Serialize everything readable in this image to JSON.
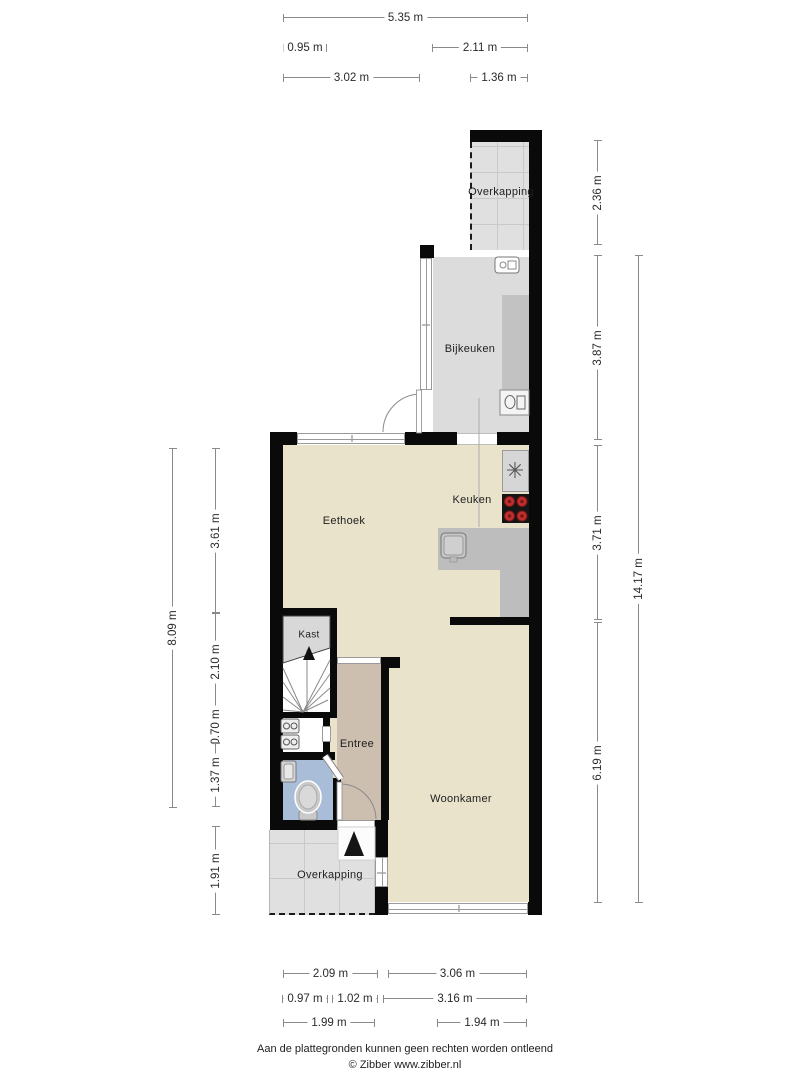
{
  "rooms": {
    "overkapping_top": "Overkapping",
    "bijkeuken": "Bijkeuken",
    "keuken": "Keuken",
    "eethoek": "Eethoek",
    "kast": "Kast",
    "entree": "Entree",
    "woonkamer": "Woonkamer",
    "overkapping_bottom": "Overkapping"
  },
  "dimensions": {
    "top": [
      {
        "label": "5.35 m"
      },
      {
        "label": "0.95 m"
      },
      {
        "label": "2.11 m"
      },
      {
        "label": "3.02 m"
      },
      {
        "label": "1.36 m"
      }
    ],
    "bottom": [
      {
        "label": "2.09 m"
      },
      {
        "label": "3.06 m"
      },
      {
        "label": "0.97 m"
      },
      {
        "label": "1.02 m"
      },
      {
        "label": "3.16 m"
      },
      {
        "label": "1.99 m"
      },
      {
        "label": "1.94 m"
      }
    ],
    "left": [
      {
        "label": "8.09 m"
      },
      {
        "label": "3.61 m"
      },
      {
        "label": "2.10 m"
      },
      {
        "label": "0.70 m"
      },
      {
        "label": "1.37 m"
      },
      {
        "label": "1.91 m"
      }
    ],
    "right": [
      {
        "label": "2.36 m"
      },
      {
        "label": "3.87 m"
      },
      {
        "label": "3.71 m"
      },
      {
        "label": "6.19 m"
      },
      {
        "label": "14.17 m"
      }
    ]
  },
  "icons": {
    "fridge_snowflake": "✳"
  },
  "colors": {
    "floor_living": "#EAE3CB",
    "floor_entree": "#CDBFAF",
    "floor_toilet": "#A9BDD9",
    "floor_utility": "#DCDCDC",
    "floor_canopy": "#E0E0E0",
    "counter": "#BDBDBD",
    "wall": "#0A0A0A",
    "stove_burner": "#C03030",
    "dimension_line": "#8A8A8A"
  },
  "footer": {
    "line1": "Aan de plattegronden kunnen geen rechten worden ontleend",
    "line2": "© Zibber www.zibber.nl"
  }
}
